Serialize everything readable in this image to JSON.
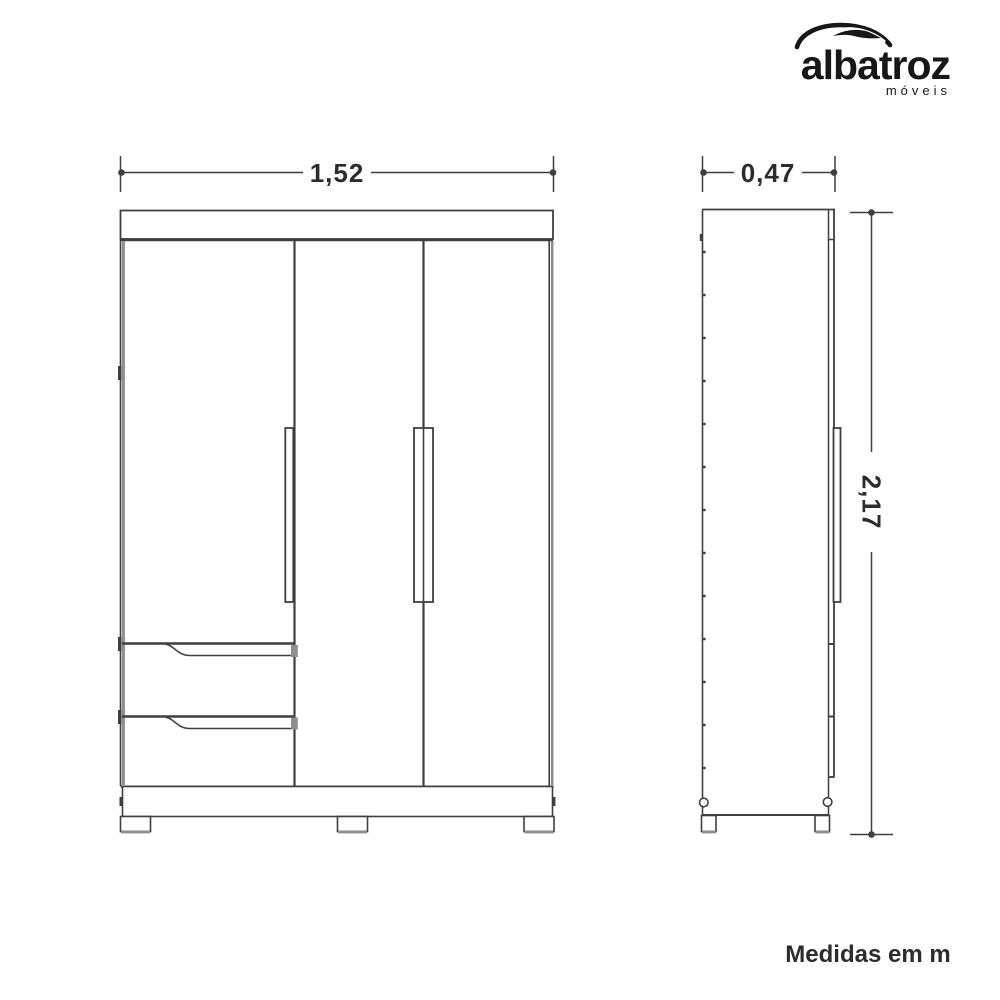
{
  "logo": {
    "brand": "albatroz",
    "subtitle": "móveis",
    "color": "#171717"
  },
  "dimensions": {
    "width": "1,52",
    "depth": "0,47",
    "height": "2,17"
  },
  "footer": {
    "note": "Medidas em m"
  },
  "colors": {
    "line": "#3f3f3f",
    "panel_gray": "#8e8e8e",
    "dimension_text": "#2c2c2c",
    "background": "#ffffff"
  }
}
